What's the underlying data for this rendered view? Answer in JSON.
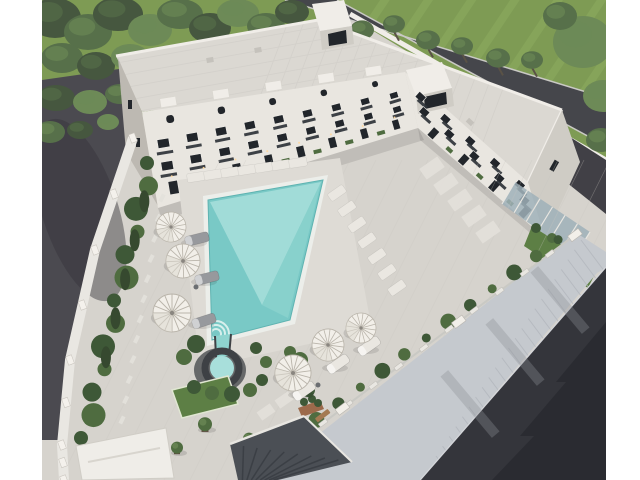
{
  "meta": {
    "image_kind": "aerial-3d-architectural-render",
    "visible_text": "none"
  },
  "colors": {
    "page_bg": "#ffffff",
    "grass": "#7e9b54",
    "grass_stripe": "#91b062",
    "tree_dark": "#46573f",
    "tree_mid": "#57704a",
    "tree_light": "#6d8a57",
    "trunk": "#5a5246",
    "road_ne": "#45464b",
    "curb": "#c9c9c4",
    "driveway": "#414046",
    "parking": "#4b4a50",
    "parking_shadow": "#35343a",
    "roof": "#dbd8d2",
    "roof_line": "#c9c6c0",
    "parapet": "#f0ede8",
    "wall_cream": "#e9e6e0",
    "wall_shade": "#cfccc5",
    "wall_dark": "#bdb9b2",
    "window_dark": "#22262b",
    "balcony_dark": "#2e3338",
    "glass": "#9fb0b8",
    "courtyard": "#d6d3cd",
    "paver_line": "#c8c5bf",
    "pool_apron": "#dedbd5",
    "slab": "#e3e0da",
    "pool_coping": "#eceeea",
    "pool_water": "#79c9c6",
    "pool_light": "#a8dfdb",
    "pool_mid": "#8fd4cf",
    "step_light": "#d7efec",
    "stone_dark": "#3e4145",
    "stone_patio": "#4a4d50",
    "hedge": "#3e5837",
    "bush": "#4f6c40",
    "conifer": "#36492f",
    "lawn": "#5d7f45",
    "lawn_border": "#e0e6d2",
    "umbrella": "#f2efe9",
    "umbrella_shade": "#ddd8cf",
    "umbrella_rib": "#b9b4aa",
    "lounger_gray": "#97999d",
    "lounger_white": "#eae7e1",
    "fence_white": "#e9e7e2",
    "sidewalk": "#c5c9ce",
    "sidewalk_line": "#b3b7bd",
    "road_se": "#34353b",
    "road_se_shadow": "#27282e",
    "pergola": "#4b4f55",
    "pergola_slat": "#3b3f45",
    "gazebo": "#efede8",
    "bench": "#a47a52",
    "planter_brick": "#9c6a4b",
    "pot": "#5a4a3c",
    "light_warm": "#ffd9a0"
  },
  "scene": {
    "subject": "L-shaped white residential building with courtyard swimming pool, aerial view",
    "building": {
      "wings": 2,
      "roof_towers": 2,
      "floors_visible": 4,
      "window_style": "dark frames with balconies",
      "roof": "flat light tiled roof"
    },
    "pool": {
      "shape": "rectangular",
      "kids_pool_attached": true,
      "corner_steps": true
    },
    "counts": {
      "umbrellas": 6,
      "sun_loungers": 6,
      "lounger_pads_rows": 2
    },
    "surroundings": {
      "top": "dense tree belt and lawn with tree row along asphalt road",
      "left": "asphalt parking strip behind white perimeter wall with conifer hedge",
      "bottom_right": "metal fence with white posts, hedge, wide paved sidewalk and dark asphalt road",
      "structures": [
        "white gazebo roof bottom-left",
        "dark pergola bottom-center",
        "glass canopies at building end",
        "wooden bench",
        "terracotta planter",
        "potted plants"
      ]
    }
  }
}
